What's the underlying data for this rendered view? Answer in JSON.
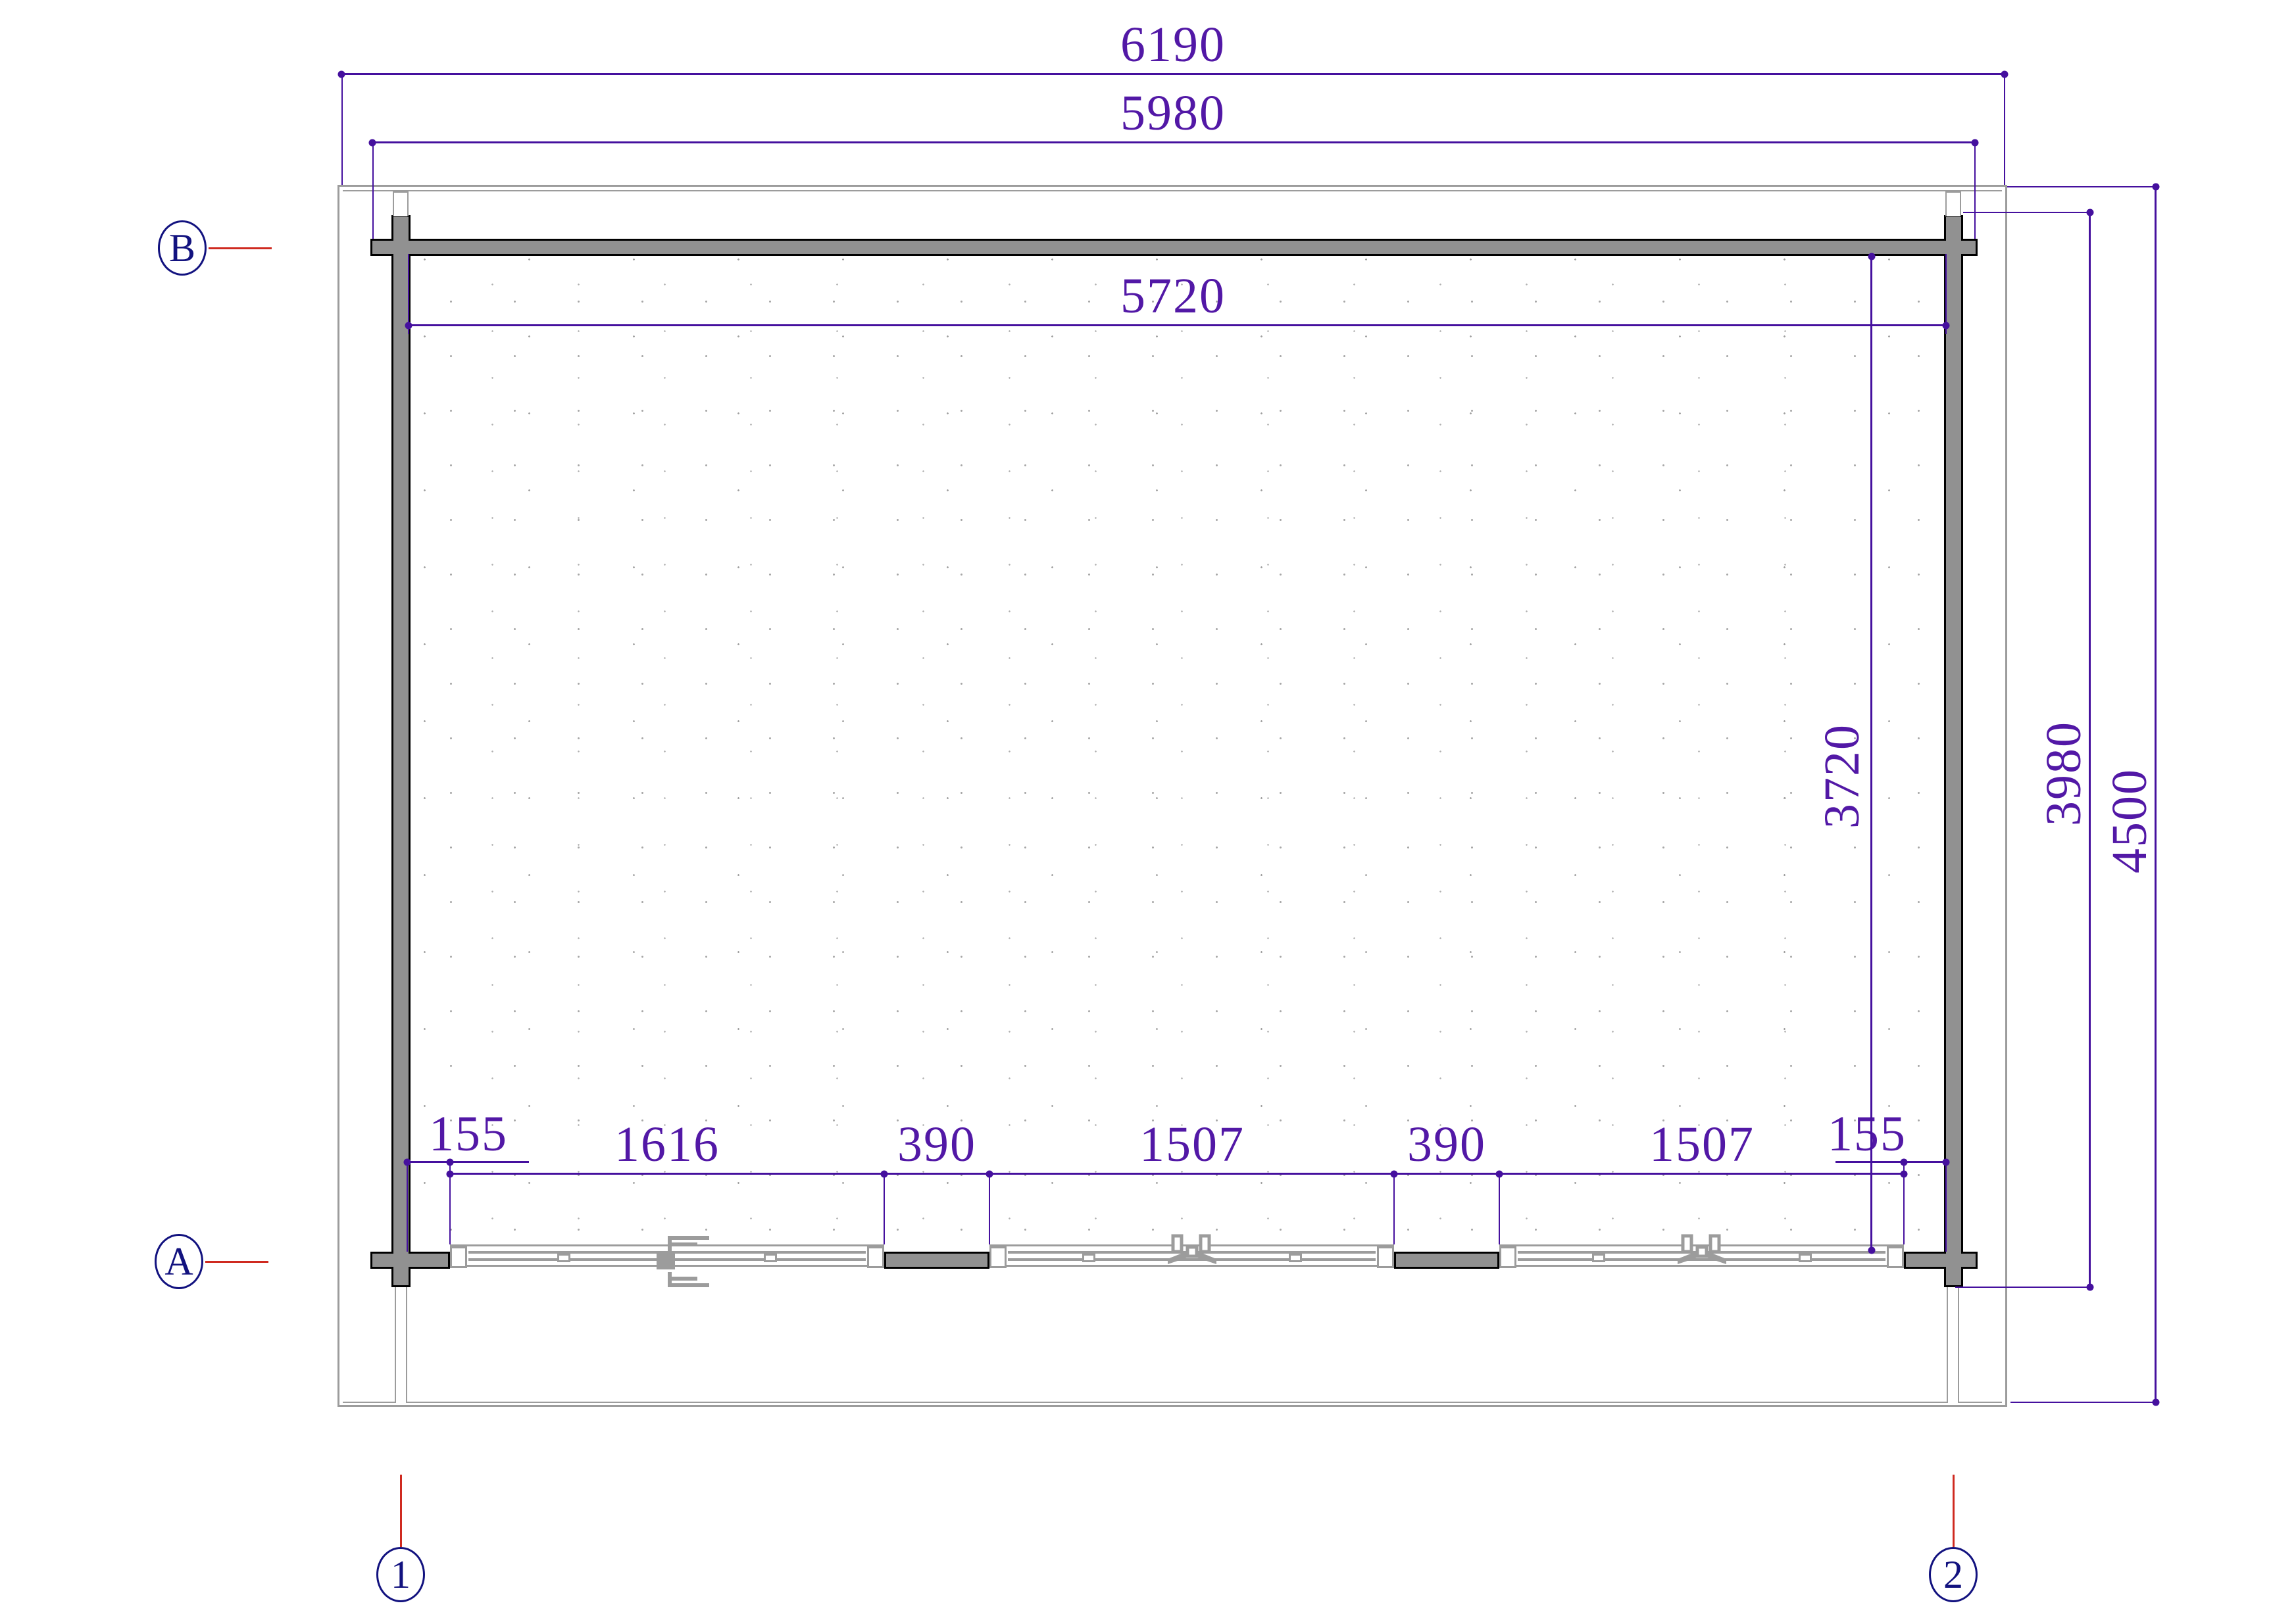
{
  "drawing_type": "floor-plan",
  "colors": {
    "purple": "#45109e",
    "ptext": "#5218a6",
    "wall": "#919191",
    "lgray": "#9c9c9c",
    "navy": "#12127f",
    "red": "#cf2a20",
    "paper": "#ffffff",
    "black": "#000000"
  },
  "dims_top": [
    {
      "label": "6190"
    },
    {
      "label": "5980"
    },
    {
      "label": "5720"
    }
  ],
  "dims_bottom": [
    {
      "label": "155"
    },
    {
      "label": "1616"
    },
    {
      "label": "390"
    },
    {
      "label": "1507"
    },
    {
      "label": "390"
    },
    {
      "label": "1507"
    },
    {
      "label": "155"
    }
  ],
  "dims_right": [
    {
      "label": "3720"
    },
    {
      "label": "3980"
    },
    {
      "label": "4500"
    }
  ],
  "grid_markers": {
    "row_b": "B",
    "row_a": "A",
    "col_1": "1",
    "col_2": "2"
  }
}
